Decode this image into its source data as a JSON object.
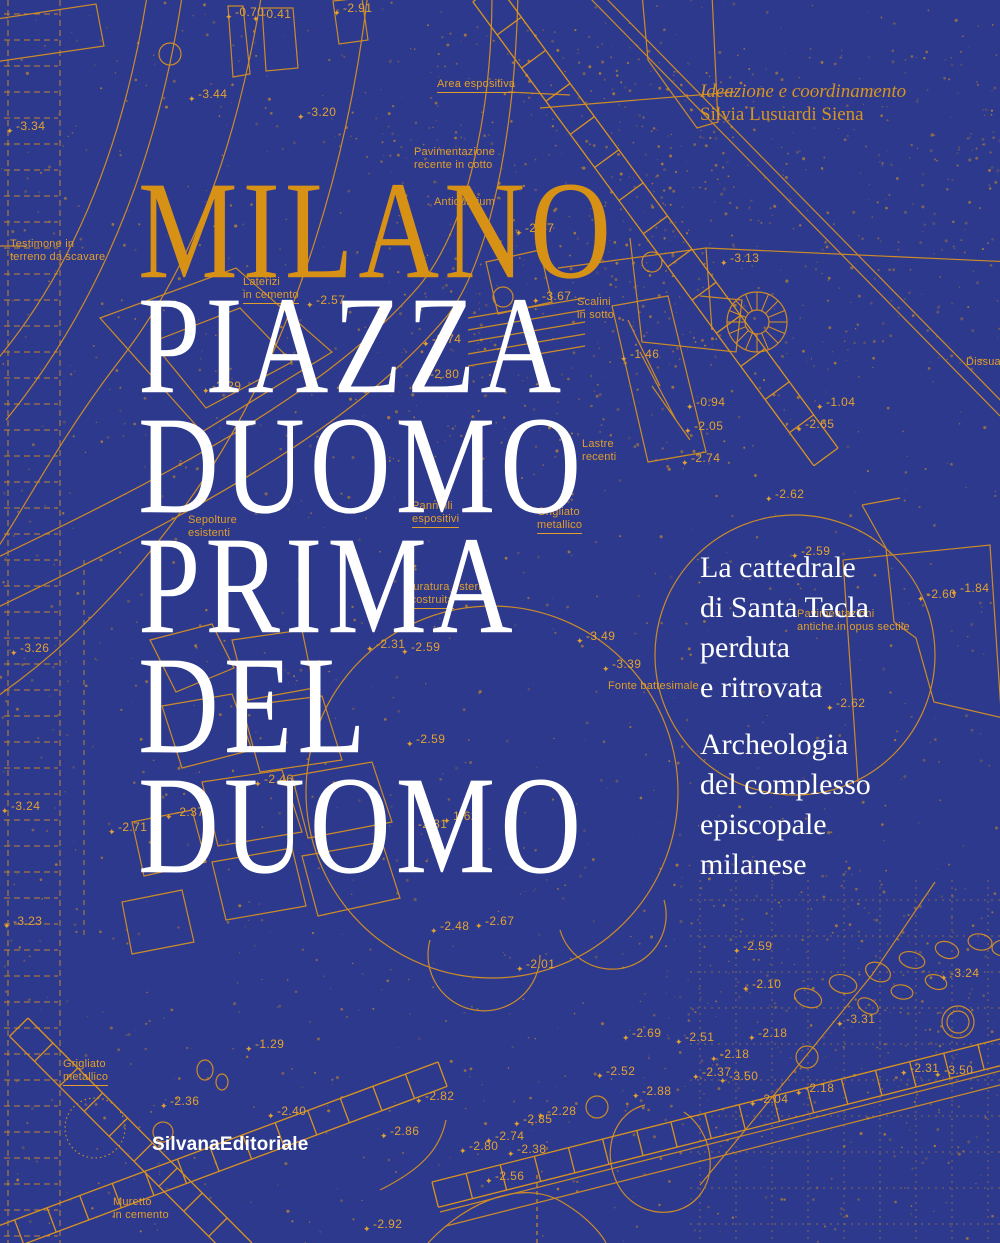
{
  "cover": {
    "credits": {
      "role": "Ideazione e coordinamento",
      "name": "Silvia Lusuardi Siena"
    },
    "title": {
      "lines": [
        {
          "text": "MILANO",
          "accent": true
        },
        {
          "text": "PIAZZA",
          "accent": false
        },
        {
          "text": "DUOMO",
          "accent": false
        },
        {
          "text": "PRIMA",
          "accent": false
        },
        {
          "text": "DEL",
          "accent": false
        },
        {
          "text": "DUOMO",
          "accent": false
        }
      ]
    },
    "subtitle": {
      "block1": [
        "La cattedrale",
        "di Santa Tecla",
        "perduta",
        "e ritrovata"
      ],
      "block2": [
        "Archeologia",
        "del complesso",
        "episcopale",
        "milanese"
      ]
    },
    "publisher": "SilvanaEditoriale",
    "colors": {
      "background": "#2c398c",
      "accent_orange": "#de9420",
      "title_gold": "#d79114",
      "text_white": "#ffffff"
    }
  },
  "plan": {
    "marker_glyph": "✦",
    "labels": [
      {
        "text": "Area espositiva",
        "x": 437,
        "y": 78,
        "u": true
      },
      {
        "text": "Pavimentazione\nrecente in cotto",
        "x": 414,
        "y": 146,
        "u": false
      },
      {
        "text": "Antiquarium",
        "x": 434,
        "y": 196,
        "u": false
      },
      {
        "text": "Testimone in\nterreno da scavare",
        "x": 10,
        "y": 238,
        "u": false
      },
      {
        "text": "Laterizi\nin cemento",
        "x": 243,
        "y": 276,
        "u": true
      },
      {
        "text": "Scalini\nin sotto",
        "x": 577,
        "y": 296,
        "u": false
      },
      {
        "text": "Lastre\nrecenti",
        "x": 582,
        "y": 438,
        "u": false
      },
      {
        "text": "Sepolture\nesistenti",
        "x": 188,
        "y": 514,
        "u": false
      },
      {
        "text": "Pannelli\nespositivi",
        "x": 412,
        "y": 500,
        "u": true
      },
      {
        "text": "Grigliato\nmetallico",
        "x": 537,
        "y": 506,
        "u": true
      },
      {
        "text": "Muratura esterna\nricostruita",
        "x": 404,
        "y": 581,
        "u": true
      },
      {
        "text": "Fonte battesimale",
        "x": 608,
        "y": 680,
        "u": false
      },
      {
        "text": "Pavimentazioni\nantiche in opus sectile",
        "x": 797,
        "y": 608,
        "u": false
      },
      {
        "text": "Dissua",
        "x": 966,
        "y": 356,
        "u": false
      },
      {
        "text": "Grigliato\nmetallico",
        "x": 63,
        "y": 1058,
        "u": true
      },
      {
        "text": "Muretto\nin cemento",
        "x": 113,
        "y": 1196,
        "u": false
      }
    ],
    "elevations": [
      {
        "v": "-0.70",
        "x": 225,
        "y": 6
      },
      {
        "v": "-0.41",
        "x": 252,
        "y": 8
      },
      {
        "v": "-2.91",
        "x": 333,
        "y": 2
      },
      {
        "v": "-3.44",
        "x": 188,
        "y": 88
      },
      {
        "v": "-3.20",
        "x": 297,
        "y": 106
      },
      {
        "v": "-3.34",
        "x": 6,
        "y": 120
      },
      {
        "v": "-2.57",
        "x": 515,
        "y": 222
      },
      {
        "v": "-3.13",
        "x": 720,
        "y": 252
      },
      {
        "v": "-2.57",
        "x": 306,
        "y": 294
      },
      {
        "v": "-3.67",
        "x": 532,
        "y": 290
      },
      {
        "v": "-2.74",
        "x": 422,
        "y": 333
      },
      {
        "v": "-1.46",
        "x": 620,
        "y": 348
      },
      {
        "v": "-2.80",
        "x": 420,
        "y": 368
      },
      {
        "v": "-3.29",
        "x": 202,
        "y": 380
      },
      {
        "v": "-0.94",
        "x": 686,
        "y": 396
      },
      {
        "v": "-2.05",
        "x": 684,
        "y": 420
      },
      {
        "v": "-1.04",
        "x": 816,
        "y": 396
      },
      {
        "v": "-2.65",
        "x": 795,
        "y": 418
      },
      {
        "v": "-2.74",
        "x": 681,
        "y": 452
      },
      {
        "v": "-2.62",
        "x": 765,
        "y": 488
      },
      {
        "v": "-2.59",
        "x": 791,
        "y": 545
      },
      {
        "v": "-1.84",
        "x": 950,
        "y": 582
      },
      {
        "v": "-2.60",
        "x": 917,
        "y": 588
      },
      {
        "v": "-3.26",
        "x": 10,
        "y": 642
      },
      {
        "v": "-2.31",
        "x": 366,
        "y": 638
      },
      {
        "v": "-2.59",
        "x": 401,
        "y": 641
      },
      {
        "v": "-3.49",
        "x": 576,
        "y": 630
      },
      {
        "v": "-3.39",
        "x": 602,
        "y": 658
      },
      {
        "v": "-2.62",
        "x": 826,
        "y": 697
      },
      {
        "v": "-2.59",
        "x": 406,
        "y": 733
      },
      {
        "v": "-2.46",
        "x": 254,
        "y": 773
      },
      {
        "v": "-3.24",
        "x": 1,
        "y": 800
      },
      {
        "v": "-2.37",
        "x": 165,
        "y": 806
      },
      {
        "v": "1.62",
        "x": 443,
        "y": 810
      },
      {
        "v": "-2.31",
        "x": 408,
        "y": 818
      },
      {
        "v": "-2.71",
        "x": 108,
        "y": 821
      },
      {
        "v": "-3.23",
        "x": 3,
        "y": 915
      },
      {
        "v": "-2.48",
        "x": 430,
        "y": 920
      },
      {
        "v": "-2.67",
        "x": 475,
        "y": 915
      },
      {
        "v": "-2.59",
        "x": 733,
        "y": 940
      },
      {
        "v": "-2.01",
        "x": 516,
        "y": 958
      },
      {
        "v": "-3.24",
        "x": 940,
        "y": 967
      },
      {
        "v": "-2.10",
        "x": 742,
        "y": 978
      },
      {
        "v": "-3.31",
        "x": 836,
        "y": 1013
      },
      {
        "v": "-2.69",
        "x": 622,
        "y": 1027
      },
      {
        "v": "-2.51",
        "x": 675,
        "y": 1031
      },
      {
        "v": "-2.18",
        "x": 748,
        "y": 1027
      },
      {
        "v": "-1.29",
        "x": 245,
        "y": 1038
      },
      {
        "v": "-2.18",
        "x": 710,
        "y": 1048
      },
      {
        "v": "-2.52",
        "x": 596,
        "y": 1065
      },
      {
        "v": "-2.31",
        "x": 900,
        "y": 1062
      },
      {
        "v": "-3.50",
        "x": 934,
        "y": 1064
      },
      {
        "v": "-2.37",
        "x": 692,
        "y": 1066
      },
      {
        "v": "-3.50",
        "x": 719,
        "y": 1070
      },
      {
        "v": "-2.88",
        "x": 632,
        "y": 1085
      },
      {
        "v": "-2.18",
        "x": 795,
        "y": 1082
      },
      {
        "v": "-2.36",
        "x": 160,
        "y": 1095
      },
      {
        "v": "-2.40",
        "x": 267,
        "y": 1105
      },
      {
        "v": "-2.04",
        "x": 749,
        "y": 1093
      },
      {
        "v": "-2.82",
        "x": 415,
        "y": 1090
      },
      {
        "v": "-2.28",
        "x": 537,
        "y": 1105
      },
      {
        "v": "-2.85",
        "x": 513,
        "y": 1113
      },
      {
        "v": "-2.86",
        "x": 380,
        "y": 1125
      },
      {
        "v": "-2.74",
        "x": 485,
        "y": 1130
      },
      {
        "v": "-2.80",
        "x": 459,
        "y": 1140
      },
      {
        "v": "-2.38",
        "x": 507,
        "y": 1143
      },
      {
        "v": "-2.56",
        "x": 485,
        "y": 1170
      },
      {
        "v": "-2.92",
        "x": 363,
        "y": 1218
      }
    ]
  }
}
